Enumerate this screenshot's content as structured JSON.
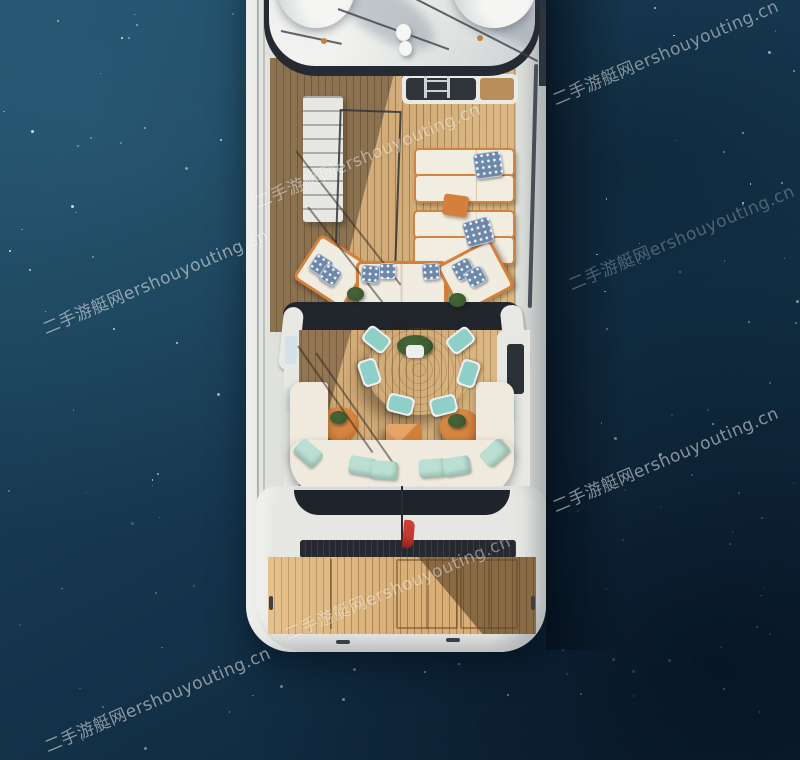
{
  "watermark": {
    "text": "二手游艇网ershouyouting.cn",
    "site_name_cn": "二手游艇网",
    "site_domain": "ershouyouting.cn",
    "instances": 7
  },
  "palette": {
    "ocean_deep": "#0f2639",
    "ocean_mid": "#15364d",
    "ocean_light": "#20506b",
    "hull_white": "#e9eae5",
    "teak_light": "#c49a63",
    "teak_shadow": "#8a6a48",
    "furniture_orange": "#d3803c",
    "cushion_white": "#f1ece0",
    "cushion_mint": "#bcdfd3",
    "cushion_aqua": "#8ed0c8",
    "pillow_blue": "#6d88a8",
    "dark_trim": "#262a32",
    "flag_red": "#c23730",
    "plant_green": "#3c5a30"
  }
}
